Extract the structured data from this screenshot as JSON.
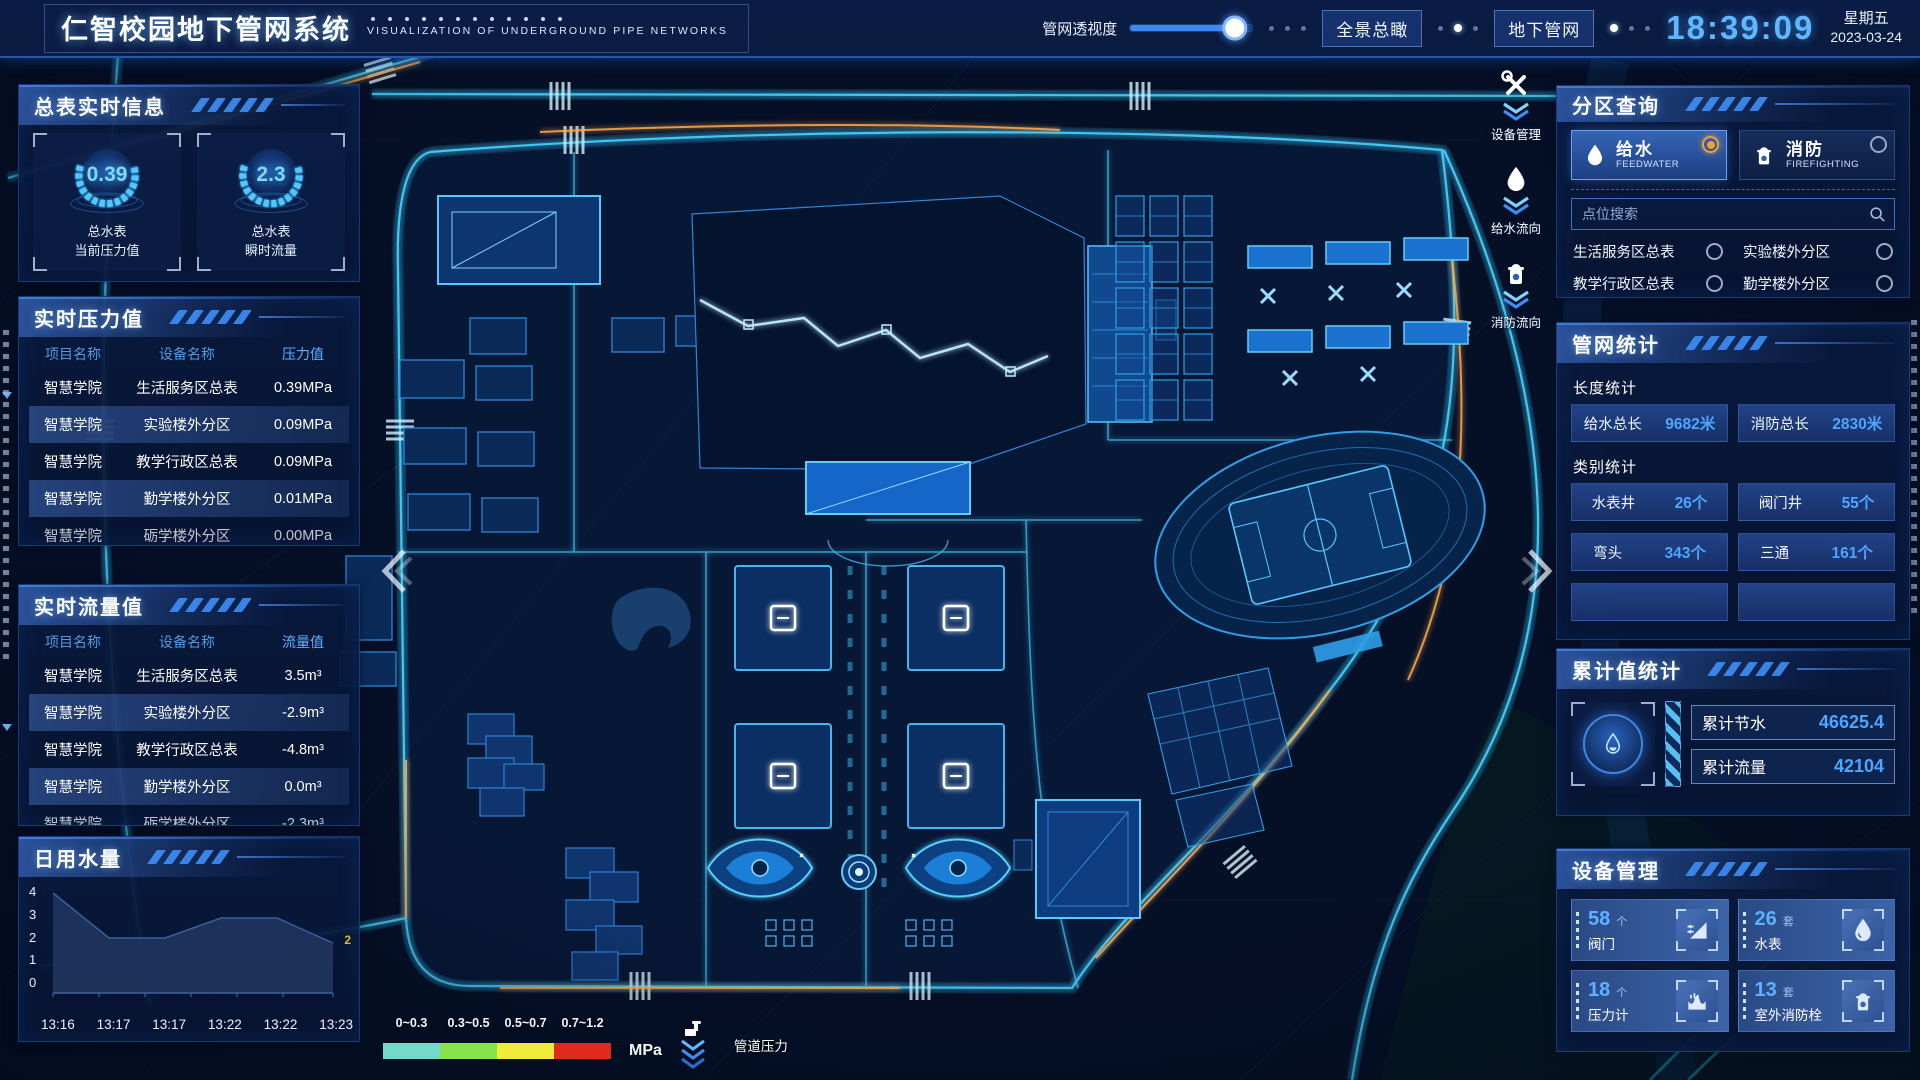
{
  "colors": {
    "accent": "#37c4f0",
    "value_blue": "#4da6ff",
    "selected_orange": "#f0a030"
  },
  "header": {
    "title": "仁智校园地下管网系统",
    "subtitle": "VISUALIZATION OF UNDERGROUND PIPE NETWORKS",
    "slider": {
      "label": "管网透视度",
      "percent": 87
    },
    "buttons": {
      "overview": "全景总瞰",
      "underground": "地下管网"
    },
    "clock": {
      "time": "18:39:09",
      "weekday": "星期五",
      "date": "2023-03-24"
    }
  },
  "left": {
    "meter": {
      "title": "总表实时信息",
      "gauges": [
        {
          "value": "0.39",
          "name": "总水表",
          "metric": "当前压力值"
        },
        {
          "value": "2.3",
          "name": "总水表",
          "metric": "瞬时流量"
        }
      ]
    },
    "pressure": {
      "title": "实时压力值",
      "headers": [
        "项目名称",
        "设备名称",
        "压力值"
      ],
      "rows": [
        {
          "project": "智慧学院",
          "device": "生活服务区总表",
          "value": "0.39MPa"
        },
        {
          "project": "智慧学院",
          "device": "实验楼外分区",
          "value": "0.09MPa"
        },
        {
          "project": "智慧学院",
          "device": "教学行政区总表",
          "value": "0.09MPa"
        },
        {
          "project": "智慧学院",
          "device": "勤学楼外分区",
          "value": "0.01MPa"
        },
        {
          "project": "智慧学院",
          "device": "砺学楼外分区",
          "value": "0.00MPa"
        }
      ]
    },
    "flow": {
      "title": "实时流量值",
      "headers": [
        "项目名称",
        "设备名称",
        "流量值"
      ],
      "rows": [
        {
          "project": "智慧学院",
          "device": "生活服务区总表",
          "value": "3.5m³"
        },
        {
          "project": "智慧学院",
          "device": "实验楼外分区",
          "value": "-2.9m³"
        },
        {
          "project": "智慧学院",
          "device": "教学行政区总表",
          "value": "-4.8m³"
        },
        {
          "project": "智慧学院",
          "device": "勤学楼外分区",
          "value": "0.0m³"
        },
        {
          "project": "智慧学院",
          "device": "砺学楼外分区",
          "value": "-2.3m³"
        }
      ]
    },
    "daily": {
      "title": "日用水量"
    }
  },
  "chart_data": {
    "type": "area",
    "title": "日用水量",
    "x": [
      "13:16",
      "13:17",
      "13:17",
      "13:22",
      "13:22",
      "13:23"
    ],
    "values": [
      4,
      2.2,
      2.2,
      3,
      3,
      2
    ],
    "yticks": [
      "4",
      "3",
      "2",
      "1",
      "0"
    ],
    "ylim": [
      0,
      4
    ],
    "end_label": "2",
    "grid": false,
    "legend_position": "none"
  },
  "map": {
    "toolbar": [
      {
        "label": "设备管理",
        "icon": "tools-icon"
      },
      {
        "label": "给水流向",
        "icon": "water-drop-icon"
      },
      {
        "label": "消防流向",
        "icon": "hydrant-icon"
      }
    ],
    "legend": {
      "items": [
        {
          "range": "0~0.3",
          "color": "#74d9c9"
        },
        {
          "range": "0.3~0.5",
          "color": "#86e34a"
        },
        {
          "range": "0.5~0.7",
          "color": "#f1eb3c"
        },
        {
          "range": "0.7~1.2",
          "color": "#df2b1f"
        }
      ],
      "unit": "MPa",
      "label": "管道压力"
    }
  },
  "right": {
    "zone": {
      "title": "分区查询",
      "types": [
        {
          "name": "给水",
          "sub": "FEEDWATER",
          "selected": true
        },
        {
          "name": "消防",
          "sub": "FIREFIGHTING",
          "selected": false
        }
      ],
      "search_placeholder": "点位搜索",
      "items": [
        "生活服务区总表",
        "实验楼外分区",
        "教学行政区总表",
        "勤学楼外分区",
        "砺学楼外分区",
        "宿舍区泵房"
      ]
    },
    "stats": {
      "title": "管网统计",
      "length_label": "长度统计",
      "length_items": [
        {
          "name": "给水总长",
          "value": "9682米"
        },
        {
          "name": "消防总长",
          "value": "2830米"
        }
      ],
      "category_label": "类别统计",
      "category_items": [
        {
          "name": "水表井",
          "value": "26个"
        },
        {
          "name": "阀门井",
          "value": "55个"
        },
        {
          "name": "弯头",
          "value": "343个"
        },
        {
          "name": "三通",
          "value": "161个"
        }
      ]
    },
    "accumulate": {
      "title": "累计值统计",
      "rows": [
        {
          "name": "累计节水",
          "value": "46625.4"
        },
        {
          "name": "累计流量",
          "value": "42104"
        }
      ]
    },
    "devices": {
      "title": "设备管理",
      "cards": [
        {
          "count": "58",
          "unit": "个",
          "name": "阀门",
          "icon": "valve-icon"
        },
        {
          "count": "26",
          "unit": "套",
          "name": "水表",
          "icon": "water-meter-icon"
        },
        {
          "count": "18",
          "unit": "个",
          "name": "压力计",
          "icon": "pressure-gauge-icon"
        },
        {
          "count": "13",
          "unit": "套",
          "name": "室外消防栓",
          "icon": "outdoor-hydrant-icon"
        }
      ]
    }
  }
}
